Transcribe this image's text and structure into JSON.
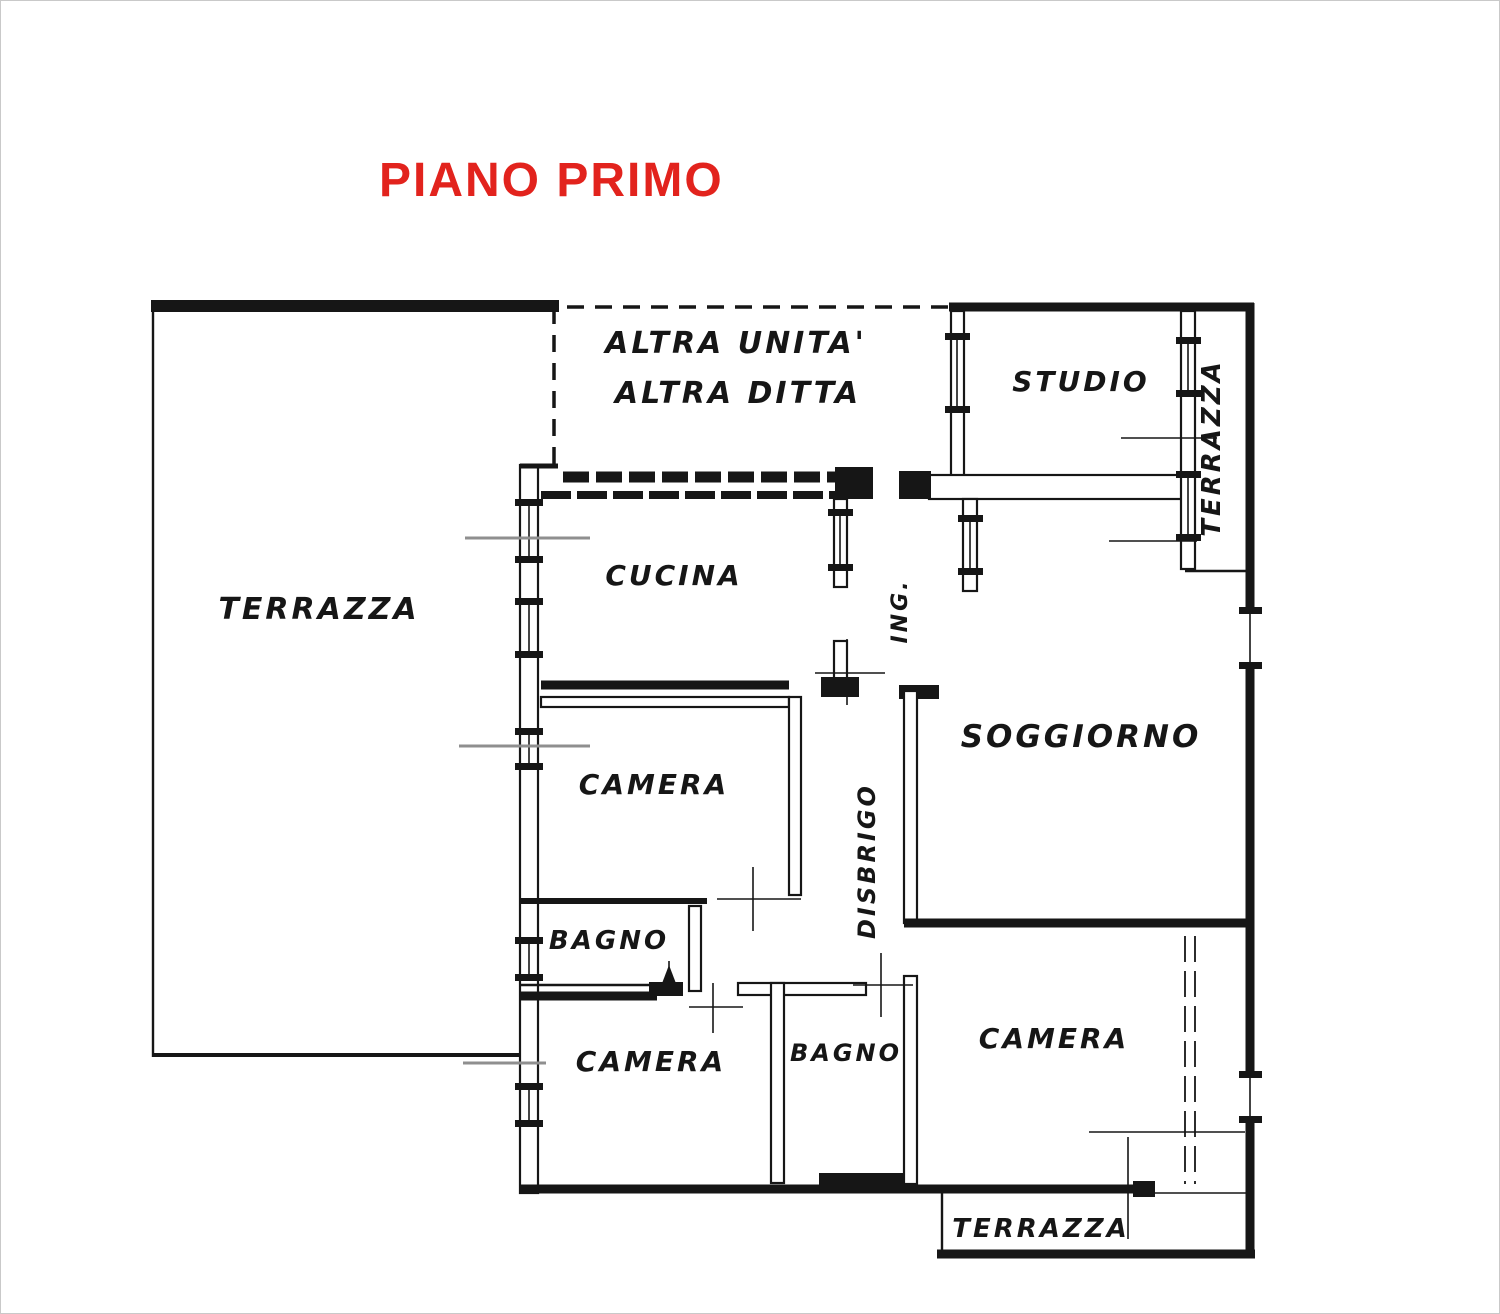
{
  "colors": {
    "bg": "#ffffff",
    "ink": "#161616",
    "title-red": "#e2231d",
    "section-gray": "#8f8f8f"
  },
  "title": {
    "text": "PIANO PRIMO"
  },
  "floor_plan": {
    "rooms": {
      "terrazza_left": "TERRAZZA",
      "altra_unita": "ALTRA  UNITA'",
      "altra_ditta": "ALTRA  DITTA",
      "studio": "STUDIO",
      "terrazza_right": "TERRAZZA",
      "cucina": "CUCINA",
      "ingresso_abbrev": "ING.",
      "soggiorno": "SOGGIORNO",
      "camera_center": "CAMERA",
      "disbrigo": "DISBRIGO",
      "bagno_left": "BAGNO",
      "camera_bottom_left": "CAMERA",
      "bagno_center": "BAGNO",
      "camera_bottom_right": "CAMERA",
      "terrazza_bottom": "TERRAZZA"
    }
  }
}
